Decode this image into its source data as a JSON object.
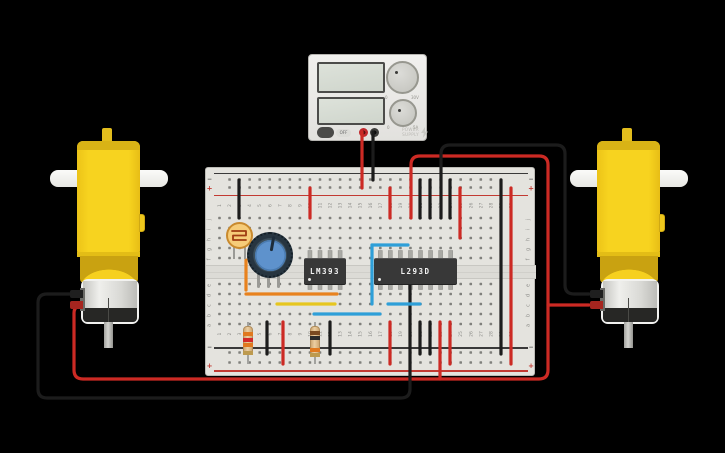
{
  "app": {
    "background": "#000000"
  },
  "power_supply": {
    "caption_line1": "POWER",
    "caption_line2": "SUPPLY",
    "toggle_label": "OFF",
    "knob_voltage": {
      "min_label": "0",
      "max_label": "30V"
    },
    "knob_current": {
      "min_label": "0",
      "max_label": "5A"
    }
  },
  "breadboard": {
    "column_count": 30,
    "row_letters_top": [
      "j",
      "i",
      "h",
      "g",
      "f"
    ],
    "row_letters_bottom": [
      "e",
      "d",
      "c",
      "b",
      "a"
    ],
    "positive_label": "+",
    "negative_label": "−",
    "colors": {
      "board": "#e4e3de",
      "hole": "#80807c",
      "positive_rail": "#c23a32",
      "negative_rail": "#3a3a3a",
      "label": "#8e8e8a"
    }
  },
  "ics": [
    {
      "label": "LM393",
      "pins": 8
    },
    {
      "label": "L293D",
      "pins": 16
    }
  ],
  "resistor1": {
    "bands": [
      {
        "color": "#e0791f",
        "y": 332
      },
      {
        "color": "#d42a2a",
        "y": 337.5
      },
      {
        "color": "#e0791f",
        "y": 343
      },
      {
        "color": "#bd9a4e",
        "y": 350.5
      }
    ]
  },
  "resistor2": {
    "bands": [
      {
        "color": "#7a4a21",
        "y": 331
      },
      {
        "color": "#2b2b2b",
        "y": 336
      },
      {
        "color": "#e0791f",
        "y": 347.5
      },
      {
        "color": "#bd9a4e",
        "y": 352.5
      }
    ]
  },
  "wires": [
    {
      "name": "supply-red-wire",
      "color": "#cc2a24",
      "d": "M362,132 L362,188"
    },
    {
      "name": "supply-black-wire",
      "color": "#1c1c1c",
      "d": "M373,132 L373,180"
    },
    {
      "name": "ground-jumper-col3-top",
      "color": "#1c1c1c",
      "d": "M239,180 L239,218"
    },
    {
      "name": "power-jumper-col10-top",
      "color": "#cc2a24",
      "d": "M310,188 L310,218"
    },
    {
      "name": "power-jumper-col18-top",
      "color": "#cc2a24",
      "d": "M390,188 L390,218"
    },
    {
      "name": "power-jumper-col25-top",
      "color": "#cc2a24",
      "d": "M460,188 L460,238"
    },
    {
      "name": "ground-jumper-col21-top",
      "color": "#1c1c1c",
      "d": "M420,180 L420,218"
    },
    {
      "name": "ground-jumper-col22-top",
      "color": "#1c1c1c",
      "d": "M430,180 L430,218"
    },
    {
      "name": "ground-jumper-col24-top",
      "color": "#1c1c1c",
      "d": "M450,180 L450,218"
    },
    {
      "name": "right-motor-red-wire",
      "color": "#cc2a24",
      "d": "M84,305 Q74,305 74,313 L74,370 Q74,379 83,379 L539,379 Q548,379 548,370 L548,165 Q548,156 539,156 L420,156 Q411,156 411,165 L411,218"
    },
    {
      "name": "right-motor-red-stub",
      "color": "#cc2a24",
      "d": "M548,305 L589,305"
    },
    {
      "name": "right-motor-black-wire",
      "color": "#1c1c1c",
      "d": "M441,218 L441,154 Q441,145 450,145 L556,145 Q565,145 565,154 L565,285 Q565,294 574,294 L589,294"
    },
    {
      "name": "left-motor-black-wire",
      "color": "#1c1c1c",
      "d": "M85,294 L47,294 Q38,294 38,303 L38,389 Q38,398 47,398 L401,398 Q410,398 410,389 L410,284"
    },
    {
      "name": "motor-red-jumper-col23-bottom",
      "color": "#cc2a24",
      "d": "M440,322 L440,379"
    },
    {
      "name": "power-jumper-col24-bottom",
      "color": "#cc2a24",
      "d": "M450,322 L450,364"
    },
    {
      "name": "power-jumper-col18-bottom",
      "color": "#cc2a24",
      "d": "M390,322 L390,364"
    },
    {
      "name": "ground-jumper-col21-bottom",
      "color": "#1c1c1c",
      "d": "M420,322 L420,354"
    },
    {
      "name": "ground-jumper-col22-bottom",
      "color": "#1c1c1c",
      "d": "M430,322 L430,354"
    },
    {
      "name": "ground-jumper-col6-bottom",
      "color": "#1c1c1c",
      "d": "M267,322 L267,354"
    },
    {
      "name": "power-jumper-col8-bottom",
      "color": "#cc2a24",
      "d": "M283,322 L283,364"
    },
    {
      "name": "ground-jumper-col12-bottom",
      "color": "#1c1c1c",
      "d": "M330,322 L330,354"
    },
    {
      "name": "rail-link-black-col29",
      "color": "#1c1c1c",
      "d": "M501,180 L501,354"
    },
    {
      "name": "rail-link-red-col30",
      "color": "#cc2a24",
      "d": "M511,188 L511,364"
    },
    {
      "name": "sensor-wire-orange-vertical",
      "color": "#e8821e",
      "d": "M246,260 L246,290"
    },
    {
      "name": "signal-wire-orange",
      "color": "#e8821e",
      "d": "M246,294 L337,294"
    },
    {
      "name": "signal-wire-yellow",
      "color": "#e6c61f",
      "d": "M277,304 L335,304"
    },
    {
      "name": "signal-wire-blue-left",
      "color": "#2e9fd8",
      "d": "M314,314 L380,314"
    },
    {
      "name": "signal-wire-blue-right",
      "color": "#2e9fd8",
      "d": "M388,304 L420,304"
    },
    {
      "name": "signal-wire-blue-vertical",
      "color": "#2e9fd8",
      "d": "M372,245 L372,304"
    },
    {
      "name": "signal-wire-blue-top",
      "color": "#2e9fd8",
      "d": "M372,245 L408,245"
    }
  ]
}
